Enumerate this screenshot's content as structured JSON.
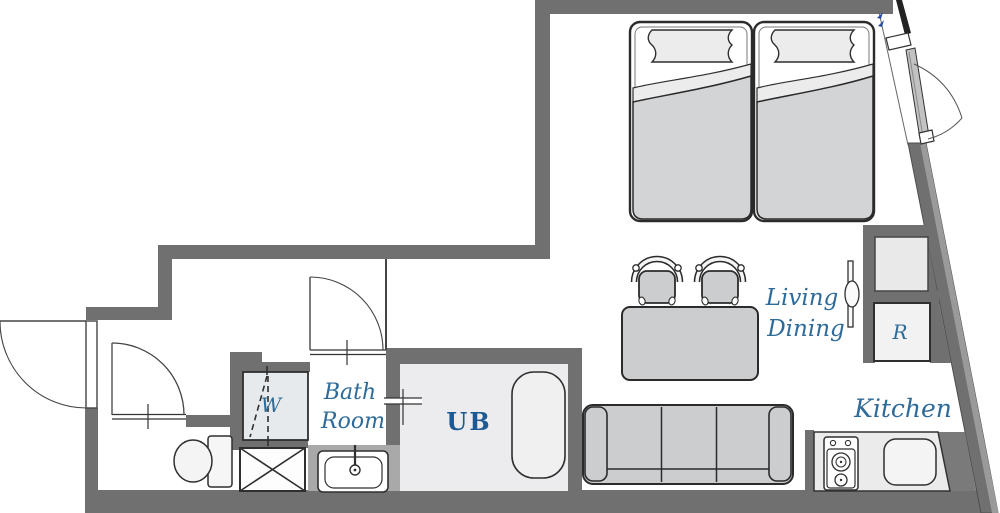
{
  "title": "Studio apartment floor plan",
  "labels": {
    "bath_line1": "Bath",
    "bath_line2": "Room",
    "unit_bath": "UB",
    "washer": "W",
    "refrigerator": "R",
    "living_line1": "Living",
    "living_line2": "Dining",
    "kitchen": "Kitchen"
  },
  "colors": {
    "wall": "#707070",
    "wall_highlight": "#9a9a9a",
    "script_blue": "#2e6b99",
    "ub_blue": "#1d5a94",
    "furniture_fill": "#ced0d2",
    "room_fill": "#ececee",
    "vanity_gray": "#a9a9a9",
    "entry_marker_blue": "#2b4ea0"
  },
  "rooms": [
    {
      "name": "bedroom",
      "furniture": [
        "bed-left",
        "bed-right"
      ]
    },
    {
      "name": "living-dining",
      "furniture": [
        "dining-table",
        "chairs",
        "sofa",
        "tv-panel"
      ]
    },
    {
      "name": "kitchen",
      "furniture": [
        "stove",
        "kitchen-sink",
        "counter",
        "refrigerator"
      ]
    },
    {
      "name": "bath-room",
      "furniture": [
        "vanity-sink"
      ]
    },
    {
      "name": "unit-bath",
      "furniture": [
        "bathtub"
      ]
    },
    {
      "name": "toilet-room",
      "furniture": [
        "toilet"
      ]
    },
    {
      "name": "laundry-space",
      "furniture": [
        "washing-machine-pan",
        "shaft-box"
      ]
    }
  ]
}
